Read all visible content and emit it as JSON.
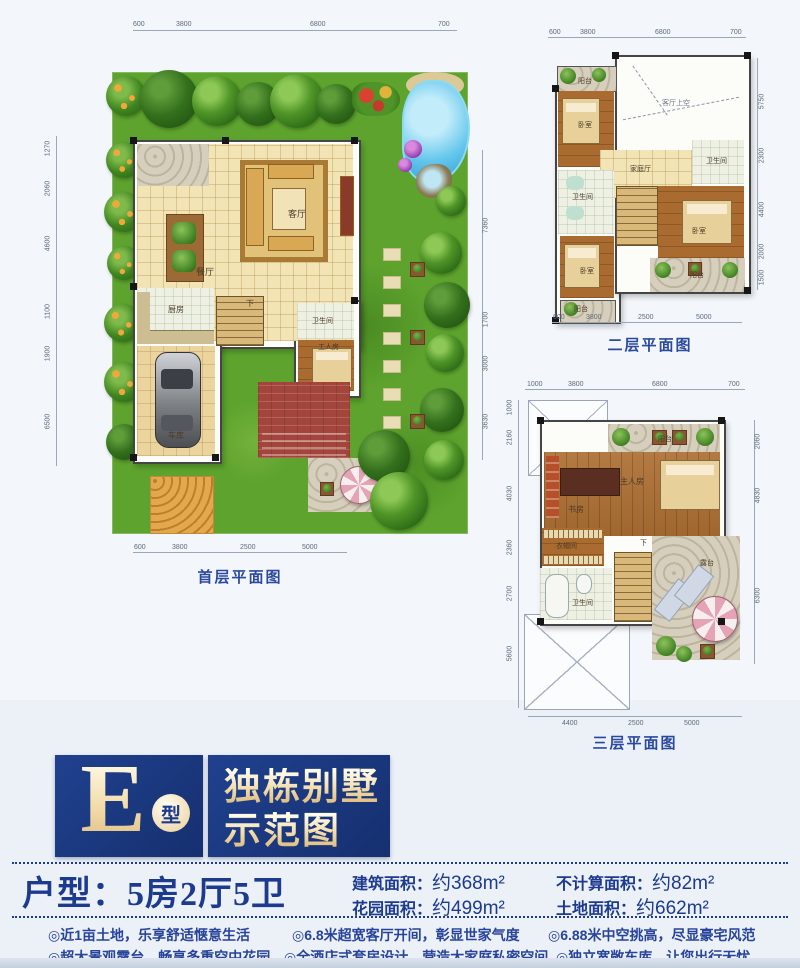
{
  "plan1": {
    "title": "首层平面图",
    "dims_top": [
      "600",
      "3800",
      "6800",
      "700"
    ],
    "dims_bottom": [
      "600",
      "3800",
      "2500",
      "5000"
    ],
    "dims_left": [
      "1270",
      "2060",
      "4600",
      "1100",
      "1900",
      "6500"
    ],
    "dims_right": [
      "7360",
      "1700",
      "3000",
      "3630"
    ],
    "rooms": {
      "living": "客厅",
      "dining": "餐厅",
      "kitchen": "厨房",
      "bath": "卫生间",
      "maid": "工人房",
      "garage": "车库",
      "stairs": "下"
    }
  },
  "plan2": {
    "title": "二层平面图",
    "dims_top": [
      "600",
      "3800",
      "6800",
      "700"
    ],
    "dims_bottom": [
      "600",
      "3800",
      "2500",
      "5000"
    ],
    "dims_right": [
      "5750",
      "2300",
      "4400",
      "2000",
      "1500"
    ],
    "rooms": {
      "balcony_top": "阳台",
      "bedroom1": "卧室",
      "void": "客厅上空",
      "family": "家庭厅",
      "bath1": "卫生间",
      "bath2": "卫生间",
      "bedroom2": "卧室",
      "bedroom3": "卧室",
      "balcony_right": "阳台",
      "balcony_bottom": "阳台"
    }
  },
  "plan3": {
    "title": "三层平面图",
    "dims_top": [
      "1000",
      "3800",
      "6800",
      "700"
    ],
    "dims_bottom": [
      "4400",
      "2500",
      "5000"
    ],
    "dims_left": [
      "1000",
      "2160",
      "4030",
      "2360",
      "2700",
      "5600"
    ],
    "dims_right": [
      "2060",
      "4830",
      "6300"
    ],
    "rooms": {
      "balcony": "阳台",
      "study": "书房",
      "master": "主人房",
      "closet": "衣帽间",
      "bath": "卫生间",
      "terrace": "露台",
      "stairs": "下"
    }
  },
  "banner": {
    "letter": "E",
    "circle": "型",
    "title_line1": "独栋别墅",
    "title_line2": "示范图"
  },
  "specs": {
    "huxing": "户型：5房2厅5卫",
    "items": [
      {
        "label": "建筑面积：",
        "value": "约368m²"
      },
      {
        "label": "花园面积：",
        "value": "约499m²"
      },
      {
        "label": "不计算面积：",
        "value": "约82m²"
      },
      {
        "label": "土地面积：",
        "value": "约662m²"
      }
    ]
  },
  "features": [
    "◎近1亩土地，乐享舒适惬意生活",
    "◎6.8米超宽客厅开间，彰显世家气度",
    "◎6.88米中空挑高，尽显豪宅风范",
    "◎超大景观露台，畅享多重空中花园",
    "◎全酒店式套房设计，营造大家庭私密空间",
    "◎独立宽敞车库，让您出行无忧"
  ],
  "colors": {
    "navy": "#1c3a8e",
    "gold": "#f3ddad",
    "grass": "#5da32d",
    "pool": "#64c6ec"
  }
}
